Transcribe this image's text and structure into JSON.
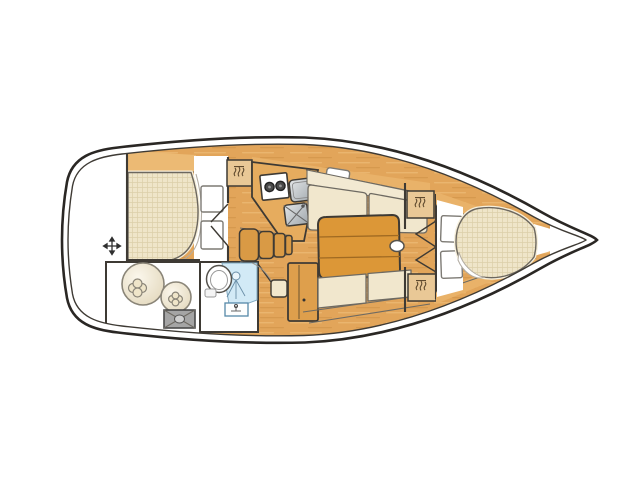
{
  "canvas": {
    "width": 640,
    "height": 480,
    "background": "#ffffff"
  },
  "diagram": {
    "type": "yacht-interior-floor-plan",
    "orientation": {
      "bow": "right",
      "stern": "left"
    },
    "colors": {
      "hull-stroke": "#2A2724",
      "outline": "#3E3A34",
      "line": "#6E6A62",
      "wood": "#E2A55A",
      "wood-trim": "#E9B269",
      "wood-top": "#ECBA74",
      "counter": "#E6AC5E",
      "table": "#DC9737",
      "table-line": "#A06A22",
      "steps": "#D99A45",
      "cabinet": "#DE9F4C",
      "locker": "#E9C896",
      "cushion": "#F1E7CD",
      "cushion-back": "#F2E9D2",
      "mattress": "#EFE5C9",
      "mattress-line": "#DCCFA9",
      "cream-border": "#F6EFDB",
      "white": "#FFFFFF",
      "shower-blue": "#D2EAF6",
      "shower-line": "#7FA8C0",
      "gray-hatch": "#A5A5A5",
      "burner": "#4A4A4A",
      "icon-dark": "#5F4A2E",
      "pillow-line": "#B2ACA2"
    },
    "regions": [
      {
        "name": "transom-swim-platform"
      },
      {
        "name": "aft-cabin-berth"
      },
      {
        "name": "storage-lazarette"
      },
      {
        "name": "head-compartment"
      },
      {
        "name": "galley"
      },
      {
        "name": "companionway-steps"
      },
      {
        "name": "nav-cabinet"
      },
      {
        "name": "saloon"
      },
      {
        "name": "forward-cabin-vberth"
      },
      {
        "name": "bow-locker"
      }
    ],
    "icons": [
      "four-way-arrow-icon",
      "hanger-icon",
      "burner-icon",
      "faucet-icon",
      "shower-icon",
      "cross-hatch-icon",
      "clover-equipment-icon"
    ]
  }
}
